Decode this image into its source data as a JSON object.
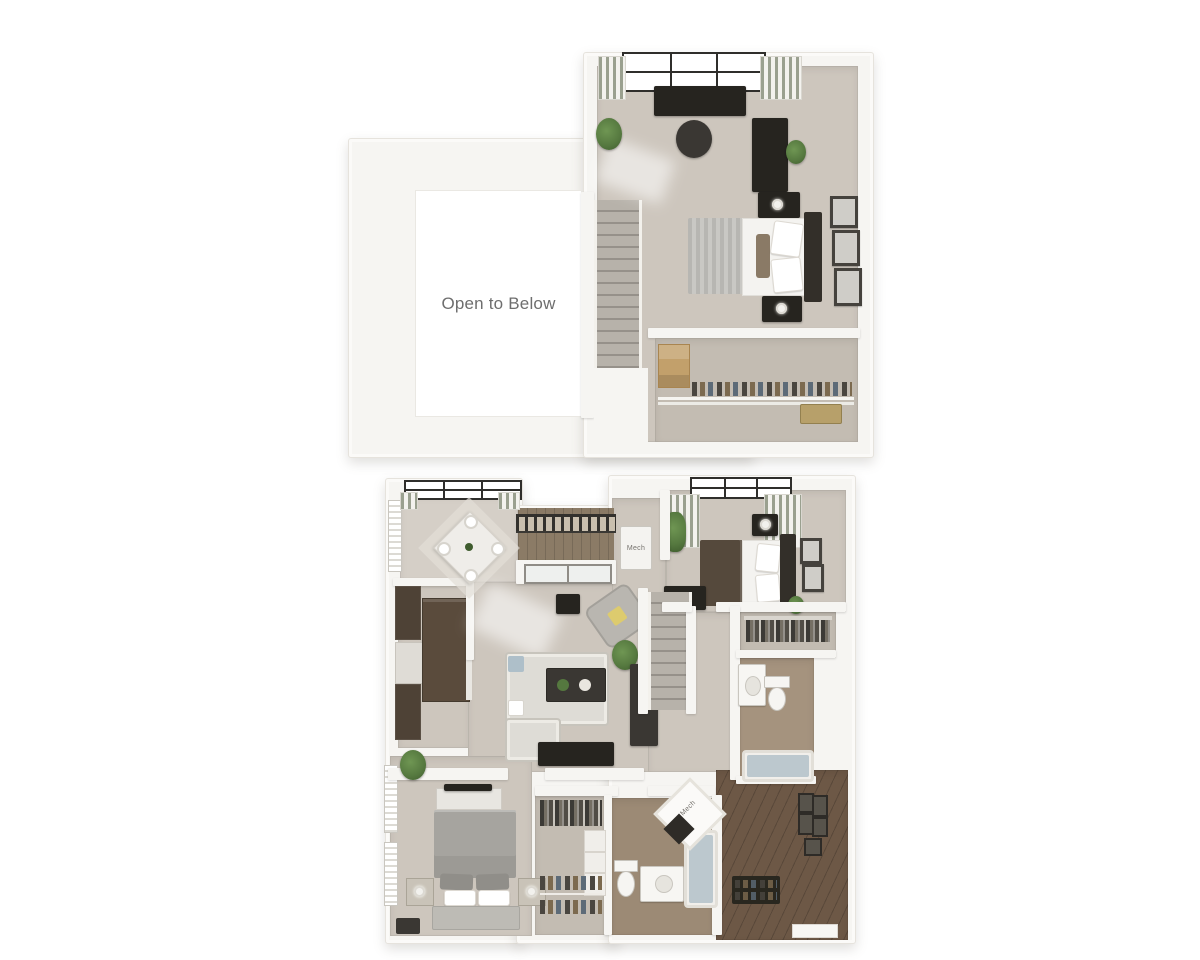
{
  "labels": {
    "open_to_below": "Open to Below",
    "mech_laundry": "Mech",
    "mech_closet": "Mech"
  },
  "palette": {
    "background": "#ffffff",
    "wall": "#f6f5f2",
    "wall-edge": "#e6e3dd",
    "carpet": "#cdc6bd",
    "carpet-dark": "#c3bcb2",
    "dining-floor": "#d5cfc7",
    "tile": "#a5937e",
    "tile-dark": "#9c8a75",
    "hardwood": "#6d5846",
    "deck": "#8b7b66",
    "cabinet": "#4e4236",
    "island": "#5a4b3c",
    "counter": "#e9e7e2",
    "black": "#26241f",
    "dark-gray": "#3a3733",
    "stair": "#b7b2aa",
    "stair-line": "#96918a",
    "bed-white": "#f4f3f0",
    "bed-gray": "#a6a49f",
    "bed-brown": "#55493c",
    "headboard": "#332f29",
    "sofa": "#dedcd6",
    "pillow-yellow": "#ddcb6e",
    "pillow-blue": "#aebfc9",
    "plant": "#55783f",
    "plant-dark": "#3f5c2e",
    "water": "#bcc8ce",
    "frame": "#45423d",
    "curtain": "#9aa08f",
    "box-tan": "#c2a06b",
    "text": "#6e6e6e"
  }
}
